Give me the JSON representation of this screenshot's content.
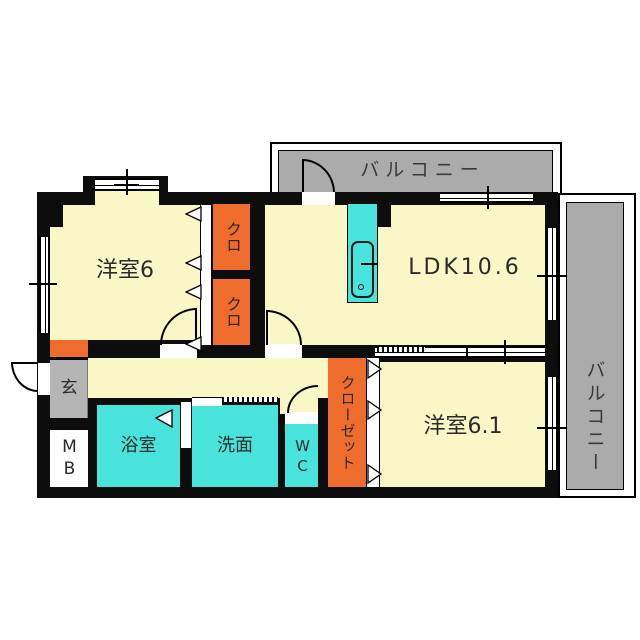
{
  "colors": {
    "wall": "#0d0d0d",
    "room_yellow": "#FAF7C6",
    "wet_cyan": "#48E4DC",
    "closet_orange": "#EE6C2C",
    "balcony_gray": "#ABABAB",
    "entrance_gray": "#B5B5B5"
  },
  "rooms": {
    "bedroom1": {
      "label": "洋室6"
    },
    "ldk": {
      "label": "LDK10.6"
    },
    "bedroom2": {
      "label": "洋室6.1"
    },
    "closet_upper": {
      "label": "クロ"
    },
    "closet_lower": {
      "label": "クロ"
    },
    "closet": {
      "label": "クローゼット"
    },
    "entrance": {
      "label": "玄"
    },
    "meter_box": {
      "label": "MB"
    },
    "bathroom": {
      "label": "浴室"
    },
    "washroom": {
      "label": "洗面"
    },
    "toilet": {
      "label": "WC"
    },
    "balcony_top": {
      "label": "バルコニー"
    },
    "balcony_right": {
      "label": "バルコニー"
    }
  }
}
